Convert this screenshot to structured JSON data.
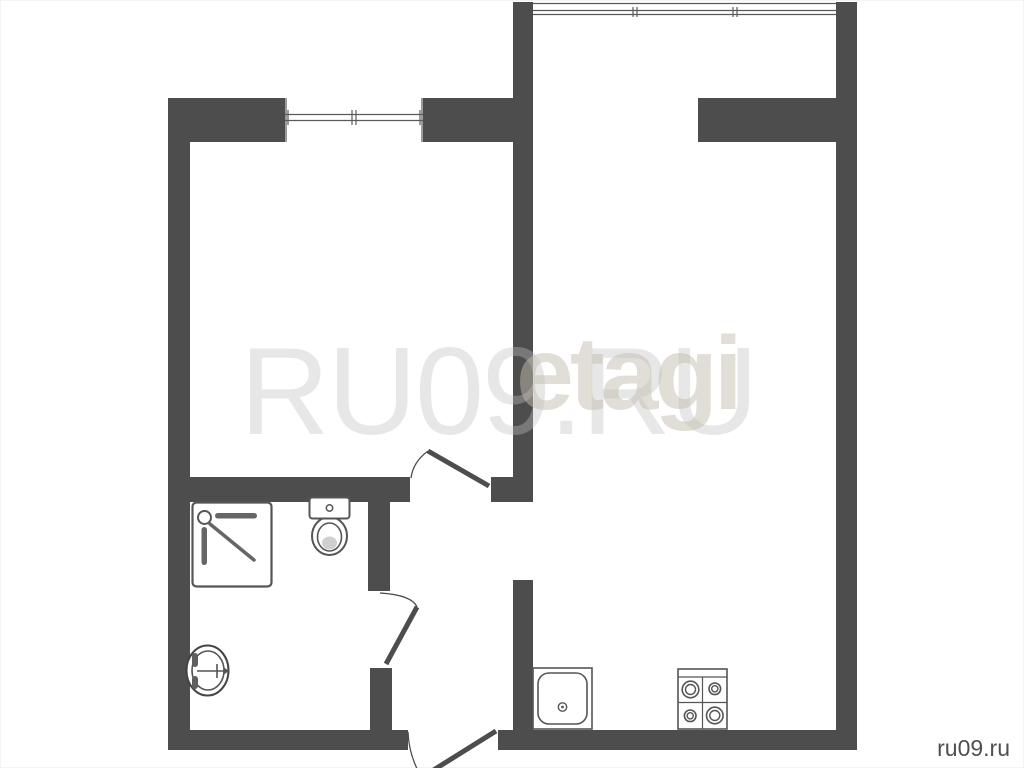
{
  "watermarks": {
    "large_text": "RU09.RU",
    "brand_text": "etagi",
    "corner_text": "ru09.ru"
  },
  "colors": {
    "wall": "#4d4d4d",
    "fixture_outline": "#555555",
    "shower_detail": "#666666",
    "watermark_large": "#ececec",
    "watermark_brand": "#e3ddd4",
    "corner_text": "#4f4f4f",
    "background": "#ffffff"
  },
  "plan": {
    "type": "apartment-floor-plan",
    "fixture_icons": [
      "shower-cabin-icon",
      "toilet-icon",
      "washbasin-icon",
      "kitchen-sink-icon",
      "stove-icon"
    ],
    "opening_icons": [
      "window-icon",
      "balcony-glazing-icon",
      "room-door-icon",
      "bathroom-door-icon",
      "entrance-door-icon"
    ]
  }
}
